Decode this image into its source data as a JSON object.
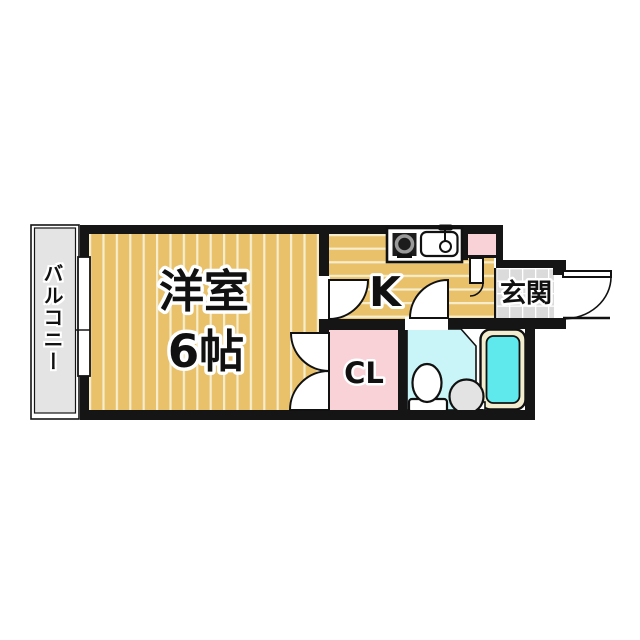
{
  "floor_plan": {
    "balcony": {
      "label": "バルコニー"
    },
    "western_room": {
      "label": "洋室",
      "size": "6帖"
    },
    "kitchen": {
      "label": "K"
    },
    "entrance": {
      "label": "玄関"
    },
    "closet": {
      "label": "CL"
    },
    "fixtures": [
      "stove",
      "kitchen-sink",
      "bathtub",
      "toilet",
      "wash-basin",
      "entry-door",
      "window"
    ],
    "colors": {
      "wall": "#151515",
      "floor_tan": "#e9c16b",
      "floor_stripe": "#f6edcc",
      "balcony_gray": "#e4e4e4",
      "entrance_tile": "#dbdbdb",
      "pink": "#f9d2d8",
      "bath_cyan": "#c9f5f8",
      "tub_water_cyan": "#5fe9ed",
      "tub_rim_cream": "#f3edcf",
      "basin_gray": "#e3e3e3"
    }
  }
}
